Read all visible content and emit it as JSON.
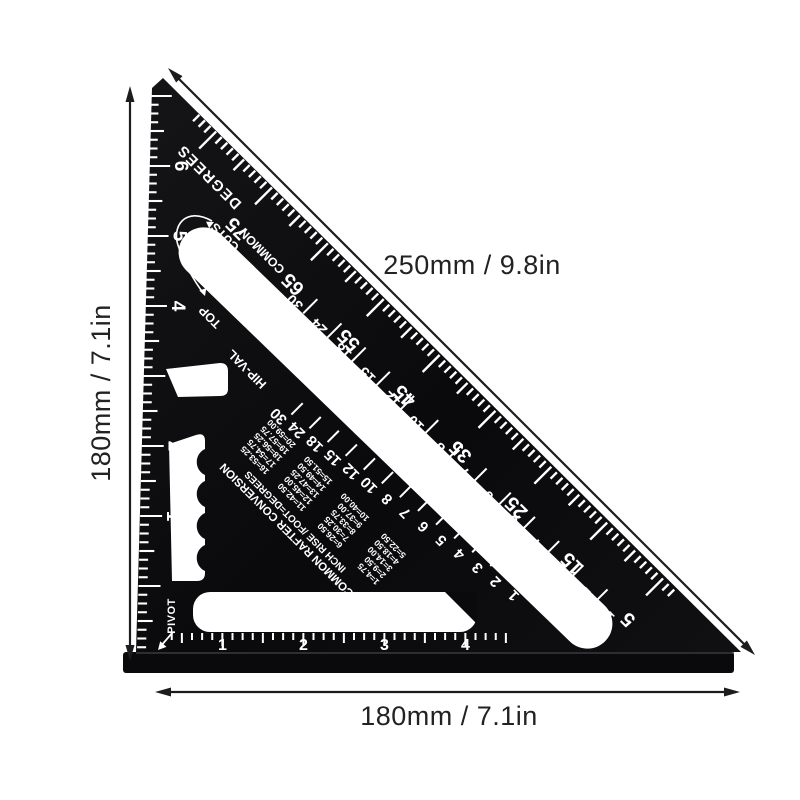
{
  "annotations": {
    "hypotenuse": "250mm / 9.8in",
    "left_side": "180mm / 7.1in",
    "bottom_side": "180mm / 7.1in"
  },
  "square": {
    "edge_labels": {
      "degrees": "DEGREES",
      "common": "COMMON",
      "cuts": "CUTS",
      "top": "TOP",
      "hip_val": "HIP-VAL",
      "pivot": "PIVOT"
    },
    "scales": {
      "degrees": [
        "75",
        "65",
        "55",
        "45",
        "35",
        "25",
        "15",
        "5"
      ],
      "common_rise": [
        "30",
        "24",
        "18",
        "15",
        "12",
        "10",
        "8",
        "7",
        "6",
        "5",
        "4",
        "3",
        "2",
        "1"
      ],
      "hip_val_rise": [
        "30",
        "24",
        "18",
        "15",
        "12",
        "10",
        "8",
        "7",
        "6",
        "5",
        "4",
        "3",
        "2",
        "1"
      ],
      "left_ruler_inches": [
        "6",
        "5",
        "4",
        "3",
        "2",
        "1"
      ],
      "bottom_ruler_inches": [
        "1",
        "2",
        "3",
        "4"
      ]
    },
    "conversion_table": {
      "title": "COMMON RAFTER CONVERSION",
      "subtitle": "INCH RISE /FOOT=DEGREES",
      "columns": [
        [
          "1=4.75",
          "2=9.50",
          "3=14.00",
          "4=18.50",
          "5=22.50"
        ],
        [
          "6=26.50",
          "7=30.25",
          "8=33.75",
          "9=37.00",
          "10=40.00"
        ],
        [
          "11=42.50",
          "12=45.00",
          "13=47.25",
          "14=49.50",
          "15=51.50"
        ],
        [
          "16=53.25",
          "17=54.75",
          "18=56.25",
          "19=57.75",
          "20=59.00"
        ]
      ]
    },
    "colors": {
      "body": "#0b0b0d",
      "markings": "#ffffff",
      "dimension": "#1c1c1c",
      "background": "#ffffff"
    }
  }
}
